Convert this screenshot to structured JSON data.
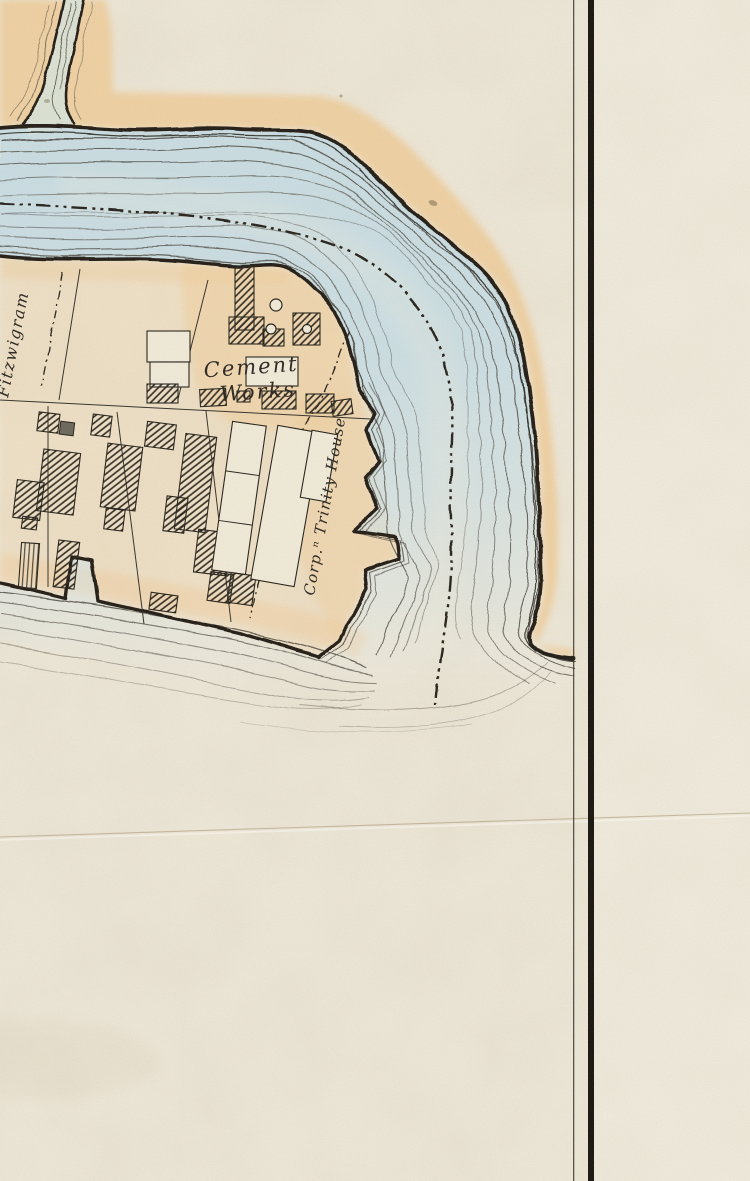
{
  "labels": {
    "fitzwigram": "Fitzwigram",
    "cement_works": {
      "line1": "Cement",
      "line2": "Works"
    },
    "trinity_house": "Corp.ⁿ Trinity House"
  },
  "colors": {
    "paper": "#efe9da",
    "paper-right": "#f3eee2",
    "water": "#c6dde6",
    "creek": "#d9e6df",
    "shore-wash": "#f1cf9f",
    "ink": "#201d16",
    "ripple": "#45413a",
    "crease": "#9c8a6b"
  }
}
